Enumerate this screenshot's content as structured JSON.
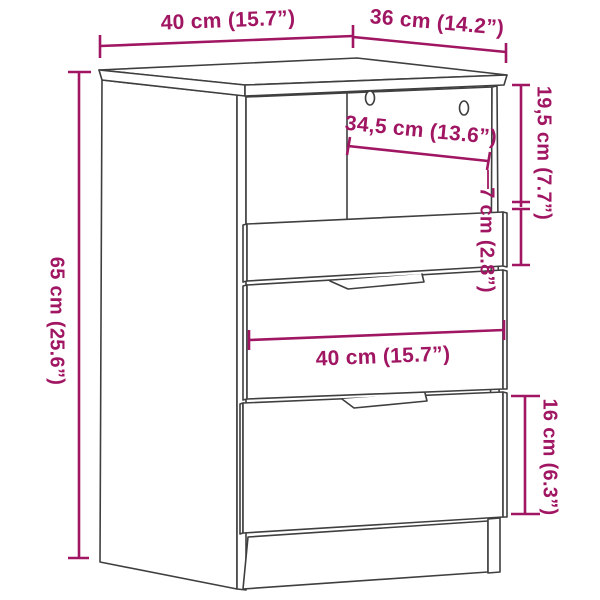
{
  "page": {
    "title": "Cabinet dimension diagram",
    "background": "#FFFFFF"
  },
  "diagram": {
    "accent_color": "#A01662",
    "line_color": "#3F3F3F",
    "labels": {
      "top_width": "40 cm (15.7”)",
      "top_depth": "36 cm (14.2”)",
      "overall_height": "65 cm (25.6”)",
      "top_section_height": "19,5 cm (7.7”)",
      "top_drawer_height": "7 cm (2.8”)",
      "inner_width": "34,5 cm (13.6”)",
      "front_width": "40 cm (15.7”)",
      "bottom_drawer_height": "16 cm (6.3”)"
    }
  }
}
